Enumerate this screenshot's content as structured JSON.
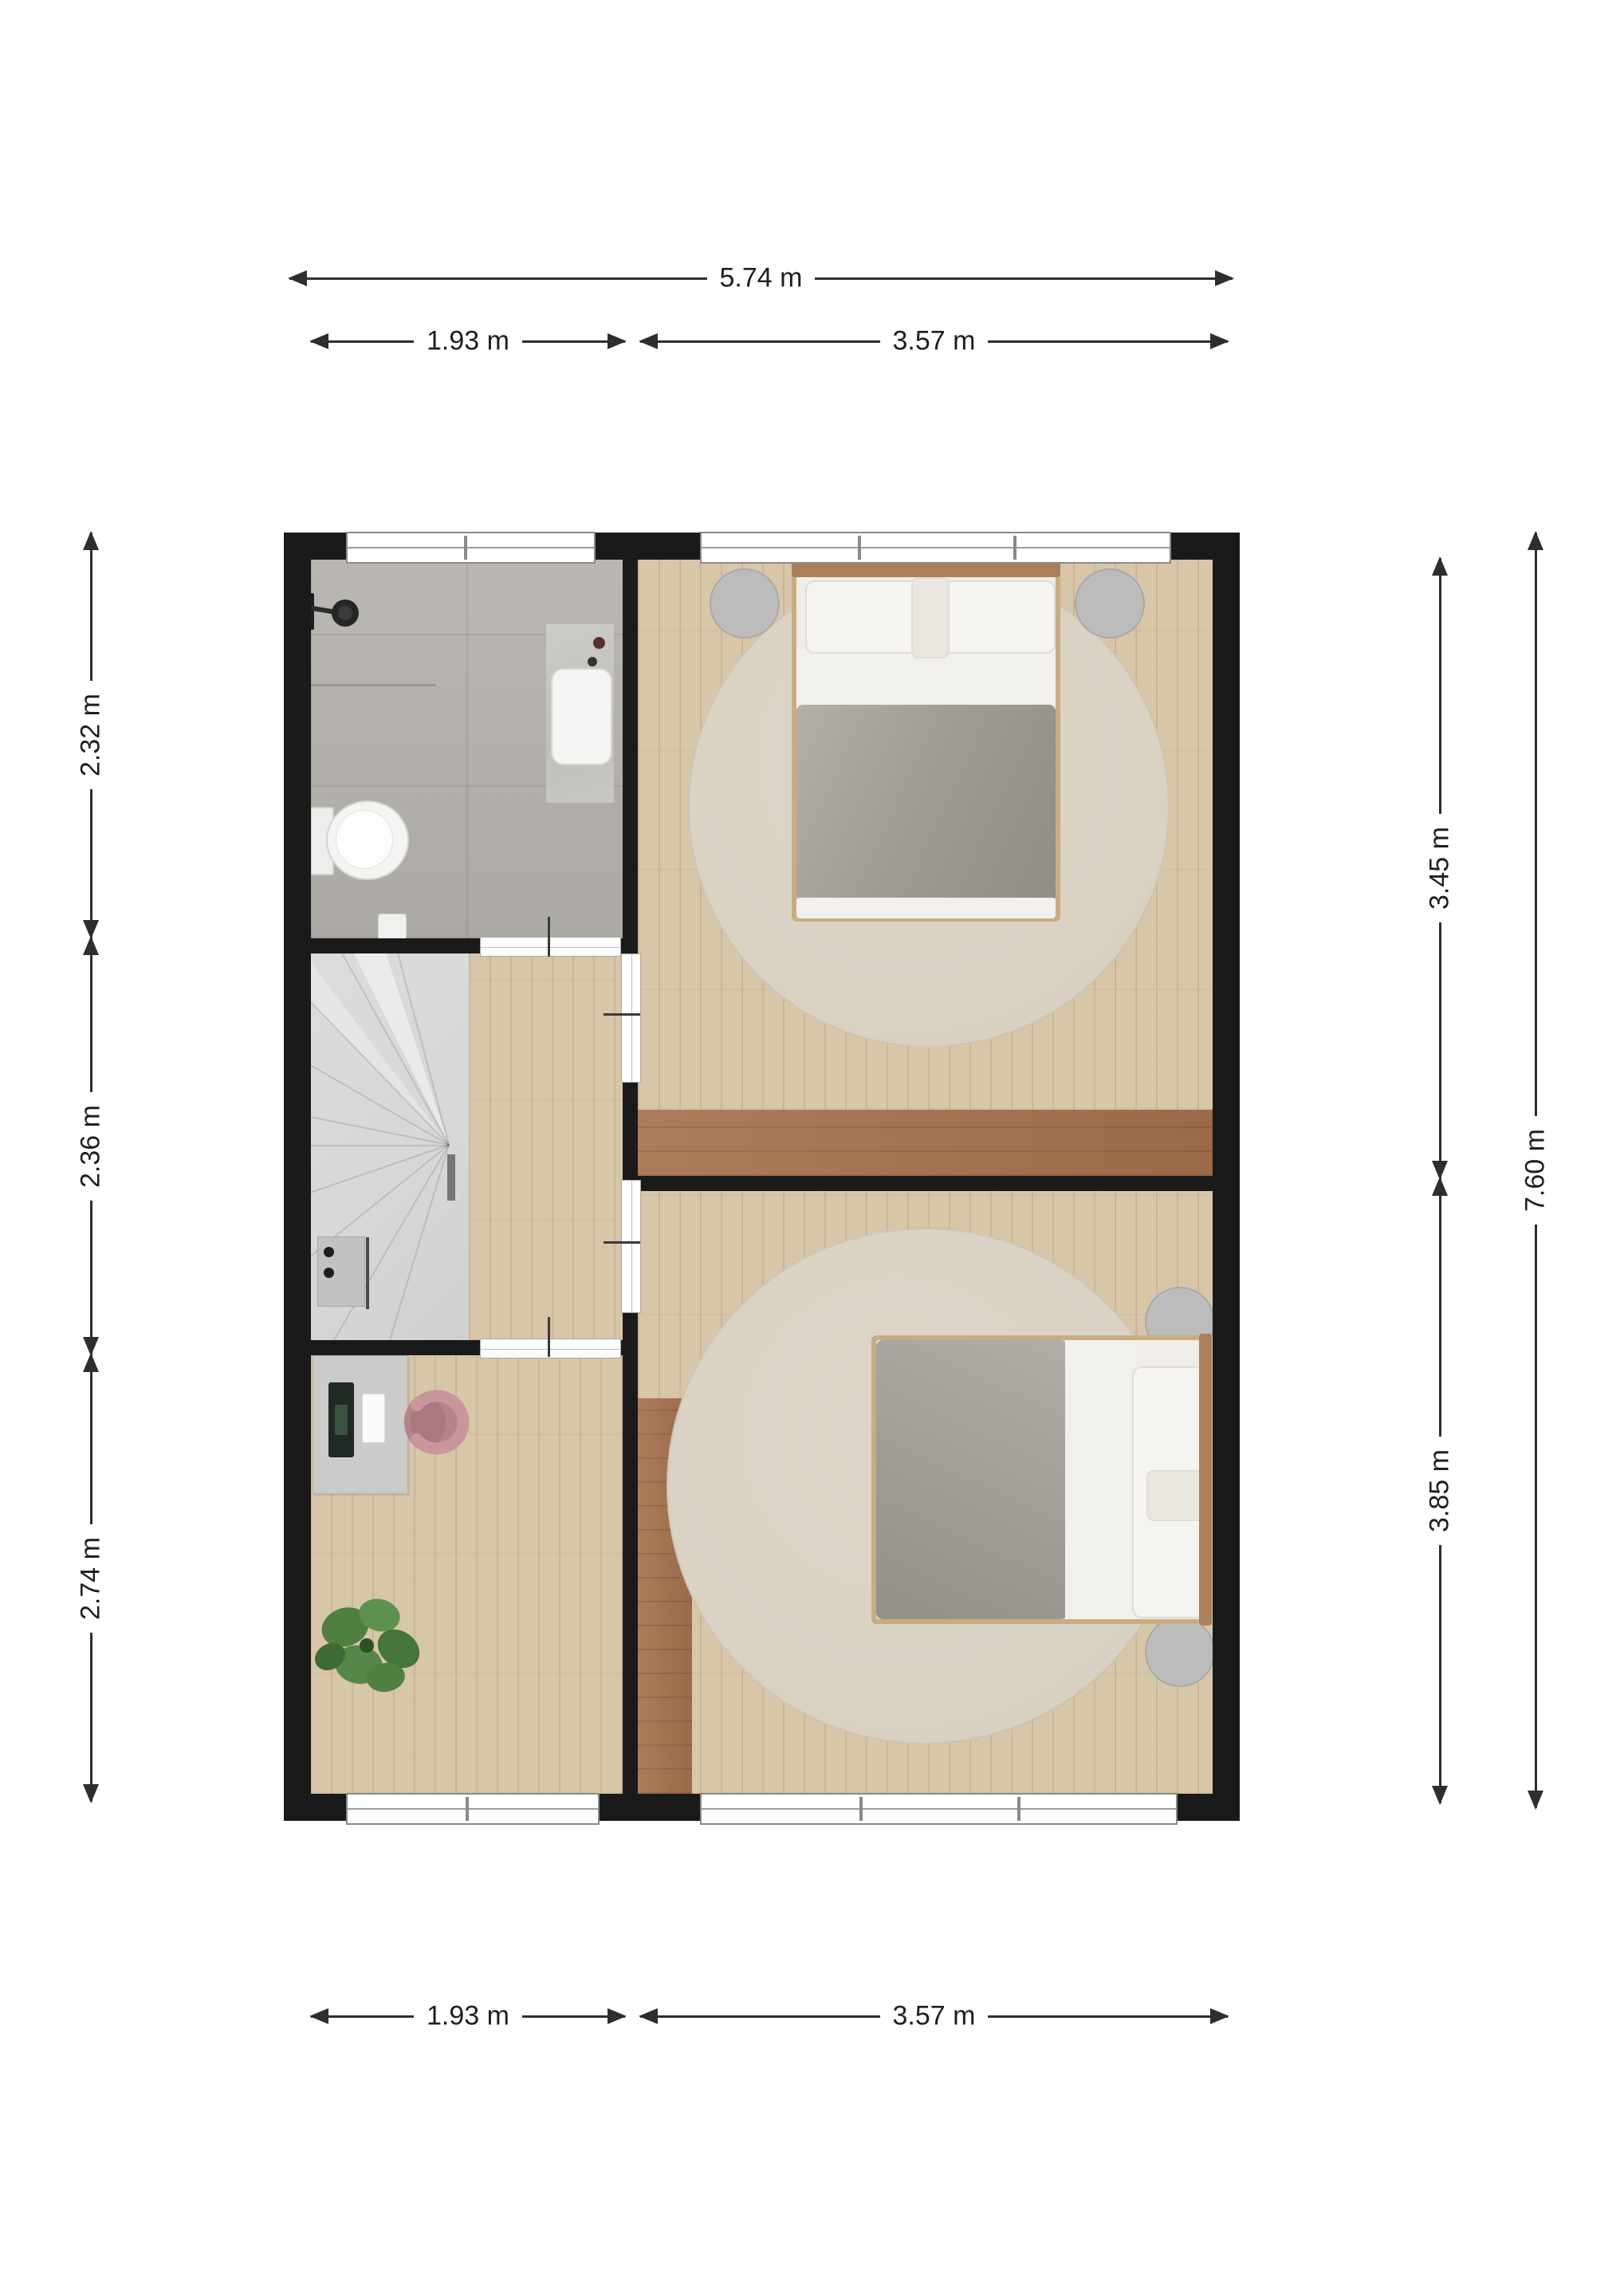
{
  "dimensions": {
    "top_total": "5.74 m",
    "top_left": "1.93 m",
    "top_right": "3.57 m",
    "left_top": "2.32 m",
    "left_middle": "2.36 m",
    "left_bottom": "2.74 m",
    "right_top": "3.45 m",
    "right_bottom": "3.85 m",
    "right_total": "7.60 m",
    "bottom_left": "1.93 m",
    "bottom_right": "3.57 m"
  },
  "colors": {
    "wall": "#1a1a1a",
    "wood": "#d8c6a8",
    "brown": "#a5714d",
    "tile": "#b5b2ad",
    "stair": "#d7d7d5",
    "rug": "#d9d1c2",
    "duvet": "#a19c95",
    "linen": "#f2f0ec",
    "pillow": "#f6f4f0",
    "nightstand": "#bcbcbc",
    "desk": "#cbcbc9",
    "chair": "#c9969c",
    "plant": "#4f7f41",
    "headboard": "#a9805b",
    "bedframe": "#c8ad83",
    "dim": "#2e2e2e"
  }
}
